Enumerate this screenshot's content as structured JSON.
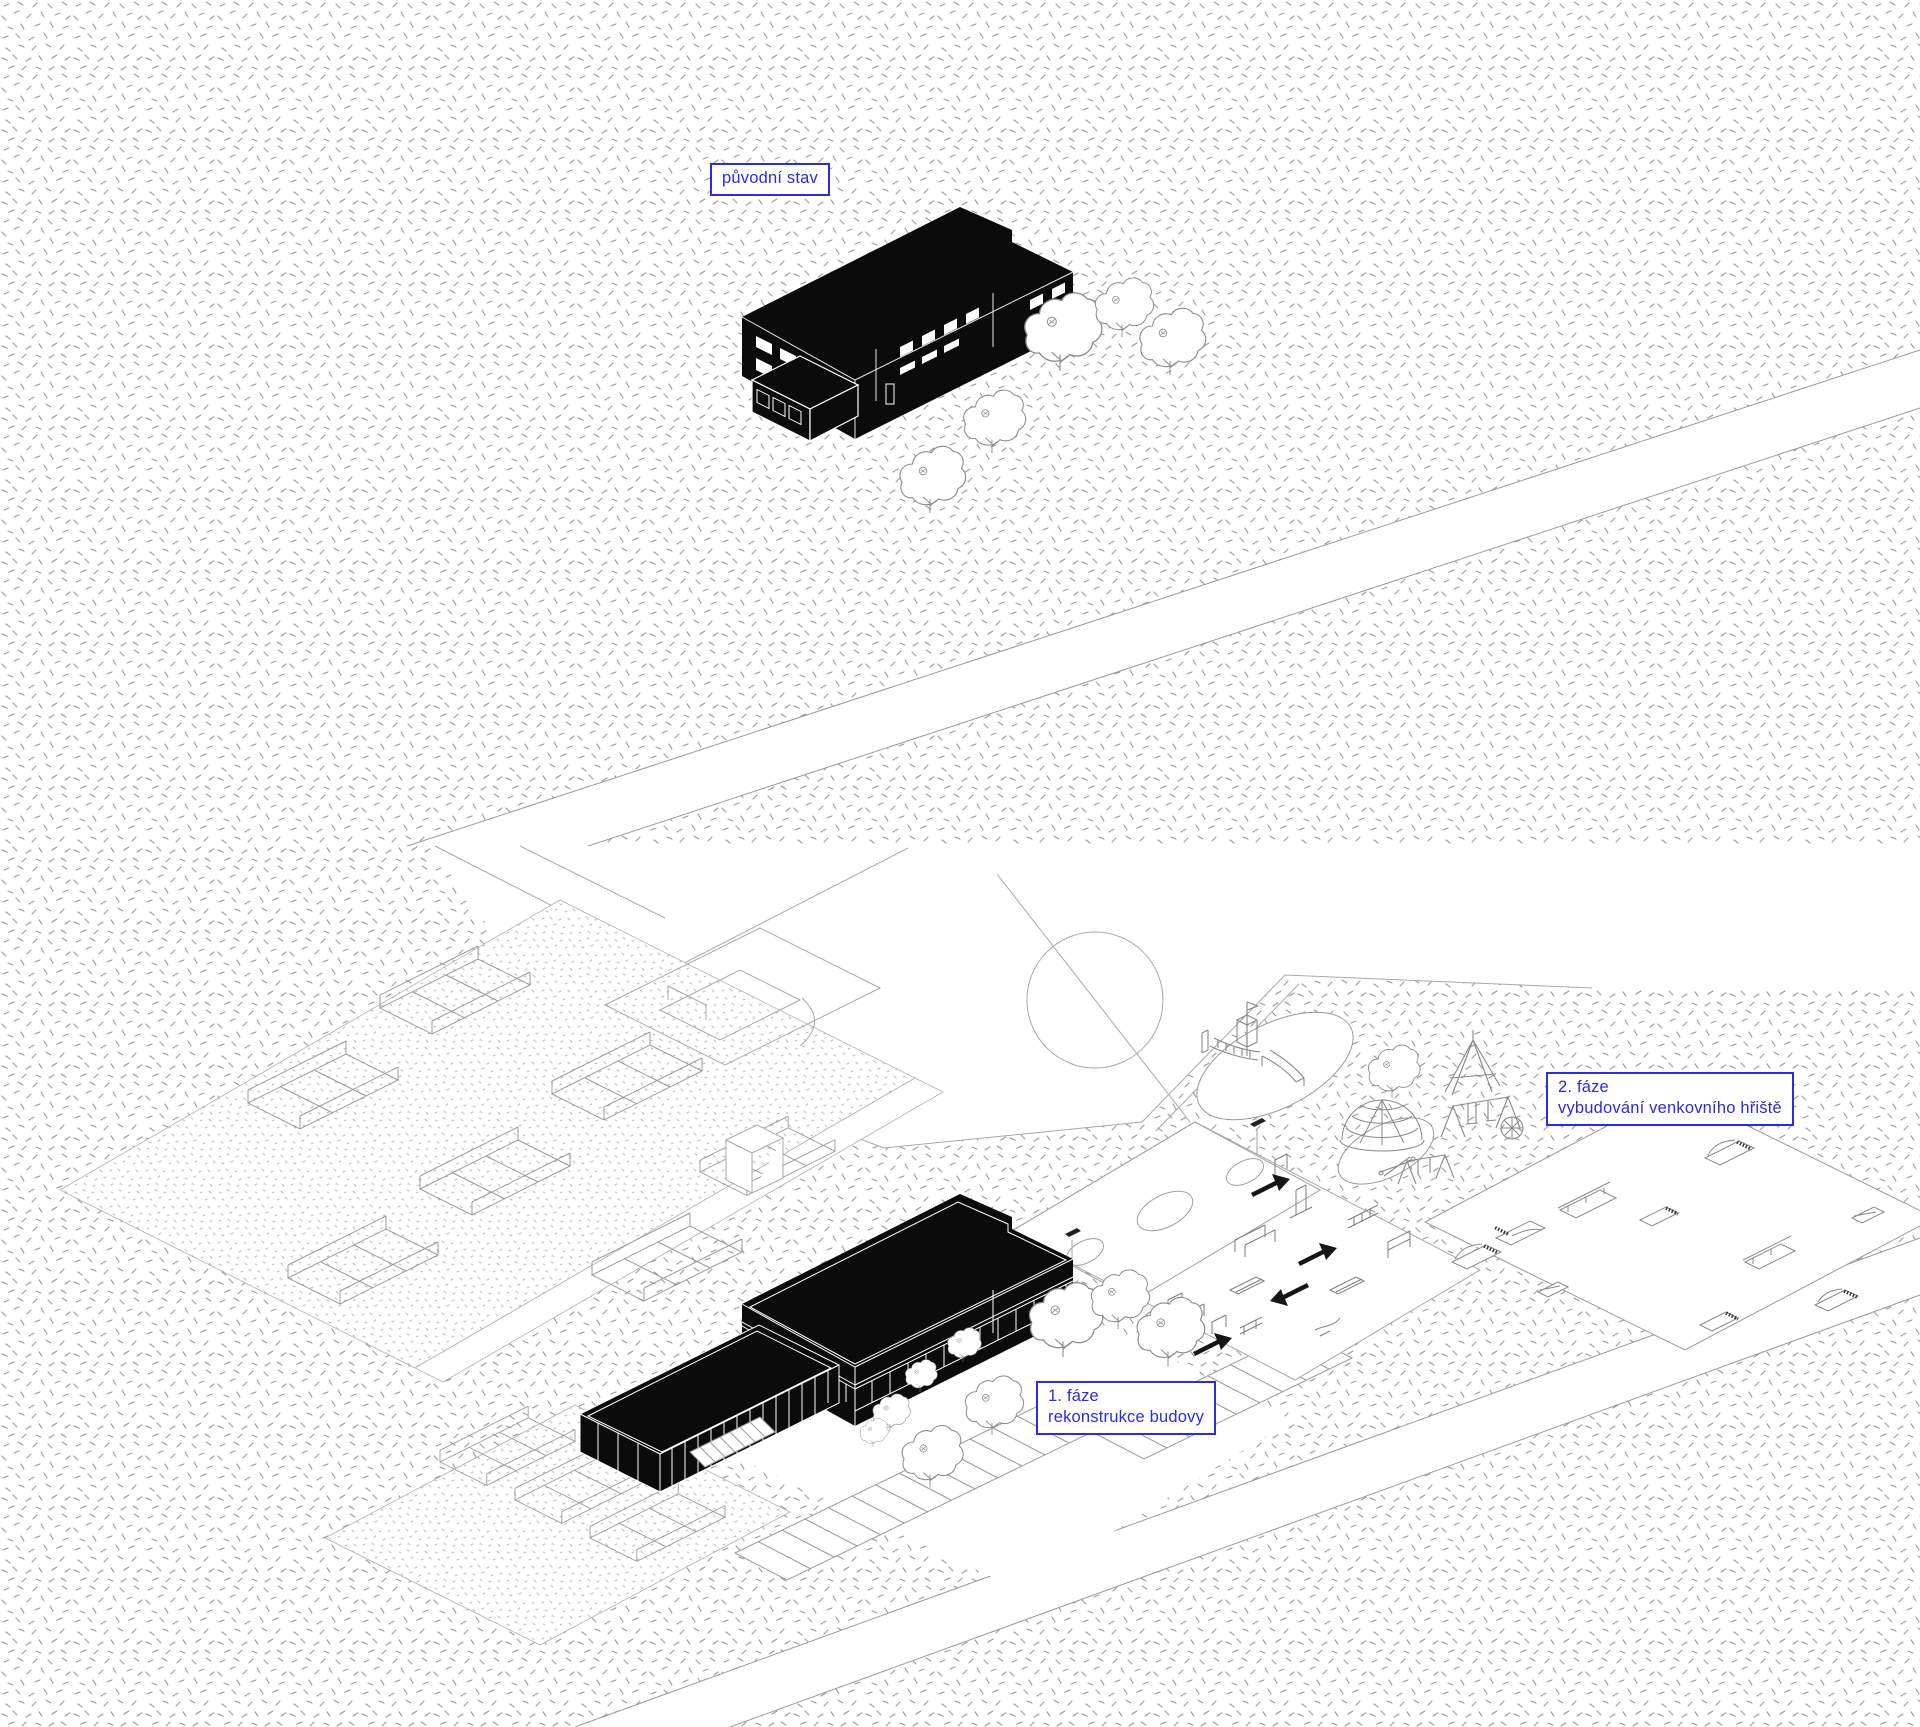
{
  "labels": {
    "original_state": "původní stav",
    "phase1": {
      "line1": "1. fáze",
      "line2": "rekonstrukce budovy"
    },
    "phase2": {
      "line1": "2. fáze",
      "line2": "vybudování venkovního hřiště"
    }
  },
  "colors": {
    "annotation_blue": "#2b2be0",
    "building_black": "#0b0b0b",
    "linework_gray": "#8f8f8f",
    "stipple_gray": "#9a9a9a",
    "background": "#ffffff"
  }
}
